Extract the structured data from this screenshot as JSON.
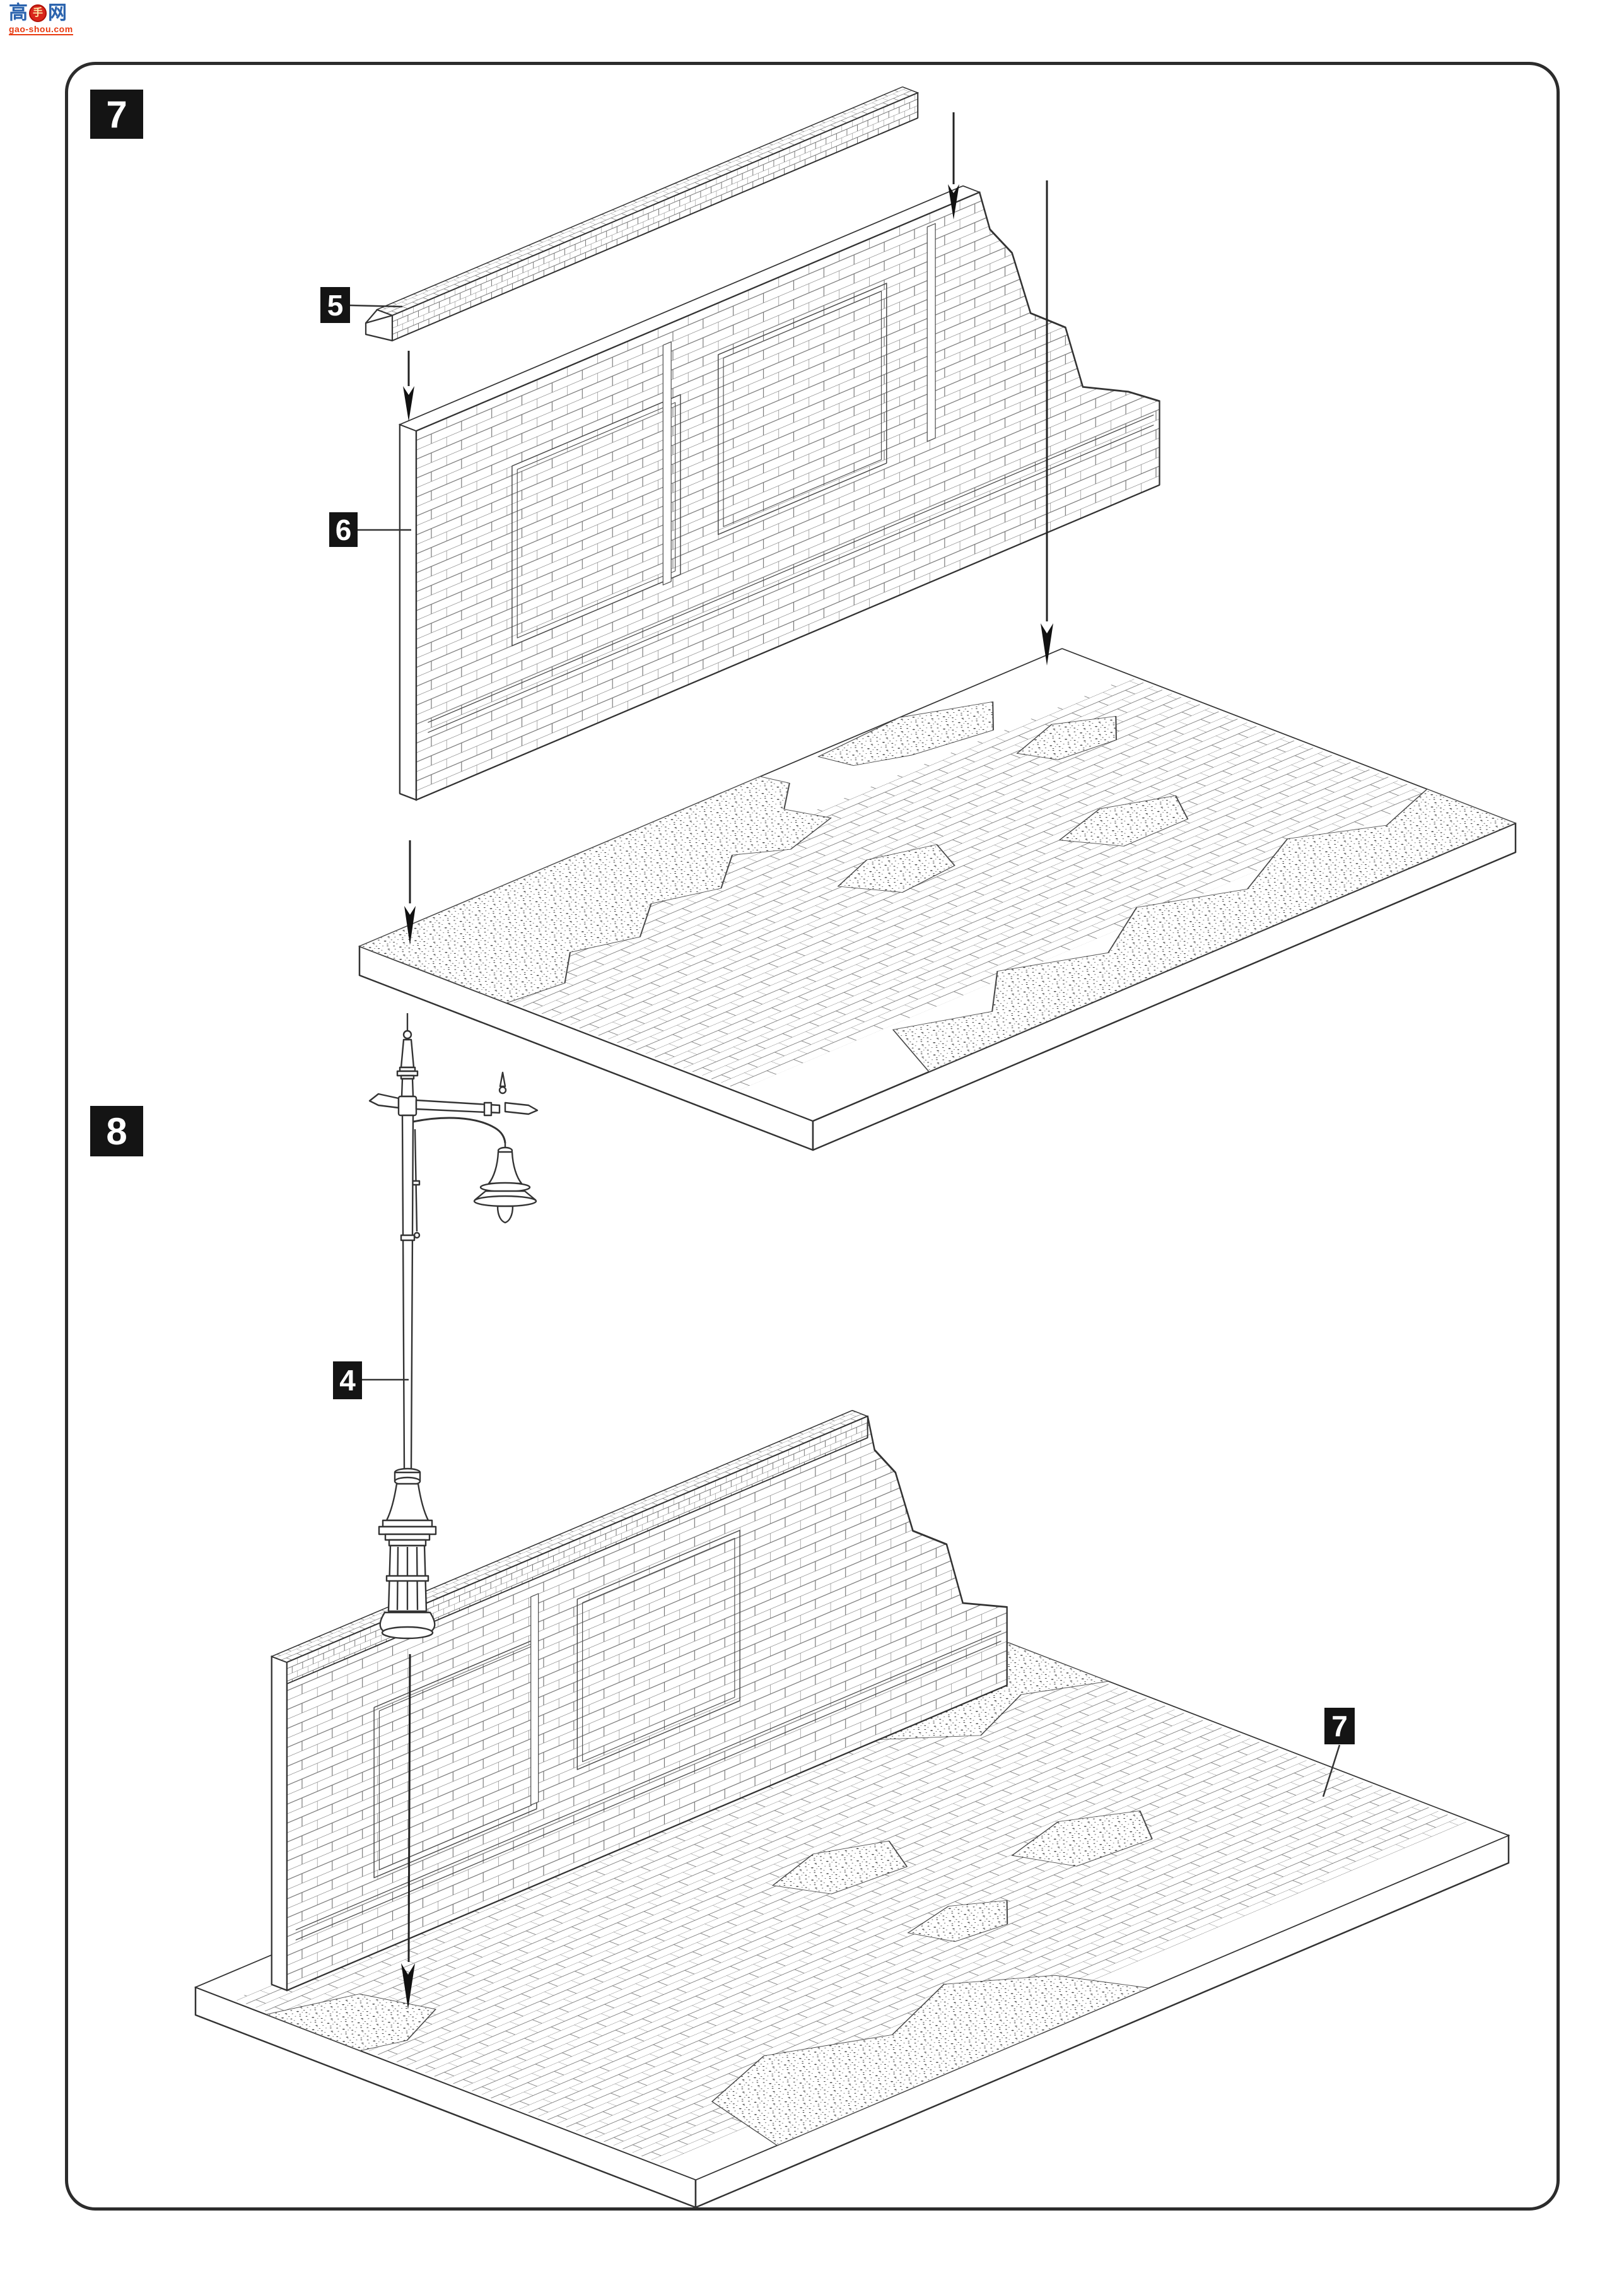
{
  "watermark": {
    "char_left": "高",
    "char_center": "手",
    "char_right": "网",
    "site": "gao-shou.com",
    "blue": "#2b63ad",
    "red": "#e8390f"
  },
  "page": {
    "background": "#ffffff",
    "border_color": "#2c2c2c"
  },
  "steps": {
    "step7": {
      "number": "7",
      "part_labels": {
        "coping": "5",
        "wall": "6"
      }
    },
    "step8": {
      "number": "8",
      "part_labels": {
        "lamp_post": "4",
        "assembled_base": "7"
      }
    }
  }
}
